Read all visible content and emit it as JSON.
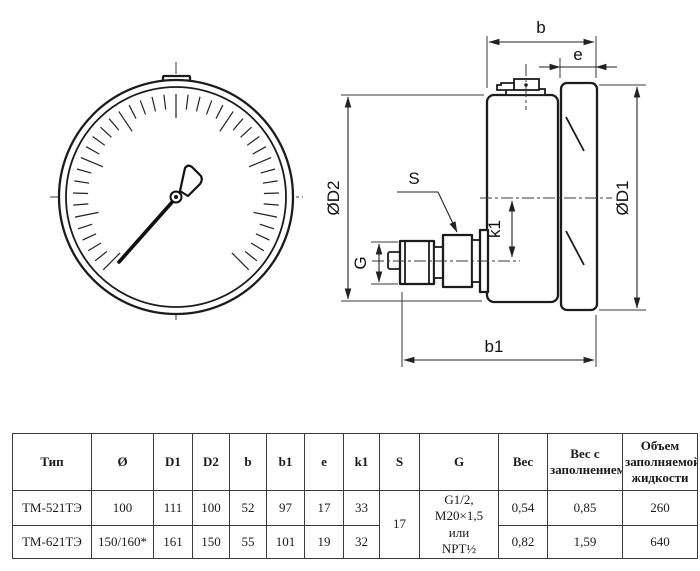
{
  "drawing": {
    "labels": {
      "b": "b",
      "e": "e",
      "d1": "ØD1",
      "d2": "ØD2",
      "s": "S",
      "g": "G",
      "k1": "k1",
      "b1": "b1"
    }
  },
  "table": {
    "headers": [
      "Тип",
      "Ø",
      "D1",
      "D2",
      "b",
      "b1",
      "e",
      "k1",
      "S",
      "G",
      "Вес",
      "Вес с заполнением",
      "Объем заполняемой жидкости"
    ],
    "rows": [
      {
        "type": "ТМ-521ТЭ",
        "d": "100",
        "d1": "111",
        "d2": "100",
        "b": "52",
        "b1": "97",
        "e": "17",
        "k1": "33",
        "weight": "0,54",
        "weight_filled": "0,85",
        "volume": "260"
      },
      {
        "type": "ТМ-621ТЭ",
        "d": "150/160*",
        "d1": "161",
        "d2": "150",
        "b": "55",
        "b1": "101",
        "e": "19",
        "k1": "32",
        "weight": "0,82",
        "weight_filled": "1,59",
        "volume": "640"
      }
    ],
    "merged": {
      "s": "17",
      "g": "G1/2,\nM20×1,5\nили\nNPT½"
    }
  }
}
